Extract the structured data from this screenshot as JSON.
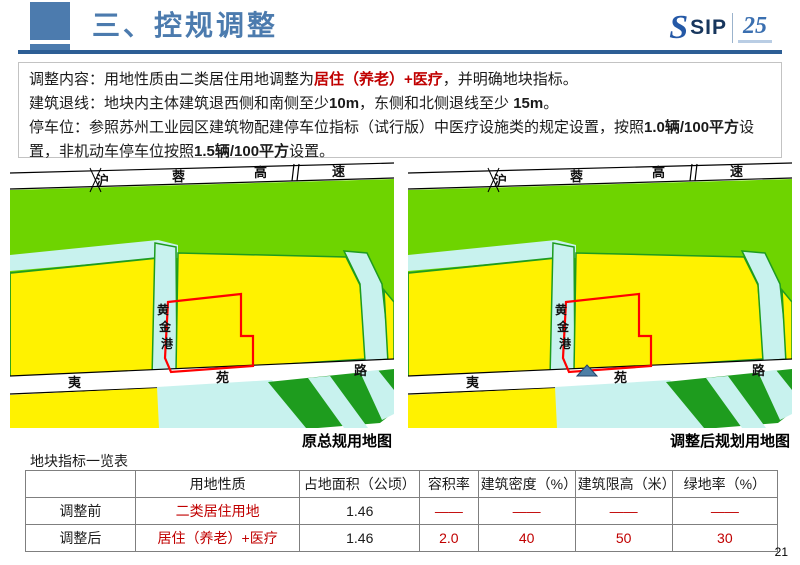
{
  "header": {
    "title": "三、控规调整",
    "logo": {
      "s": "S",
      "sip": "SIP",
      "anniversary": "25"
    }
  },
  "content": {
    "lines": [
      {
        "segments": [
          {
            "t": "调整内容：用地性质由二类居住用地调整为",
            "s": "normal"
          },
          {
            "t": "居住（养老）+医疗",
            "s": "red-bold"
          },
          {
            "t": "，并明确地块指标。",
            "s": "normal"
          }
        ]
      },
      {
        "segments": [
          {
            "t": "建筑退线：地块内主体建筑退西侧和南侧至少",
            "s": "normal"
          },
          {
            "t": "10m",
            "s": "bold"
          },
          {
            "t": "，东侧和北侧退线至少 ",
            "s": "normal"
          },
          {
            "t": "15m",
            "s": "bold"
          },
          {
            "t": "。",
            "s": "normal"
          }
        ]
      },
      {
        "segments": [
          {
            "t": "停车位：参照苏州工业园区建筑物配建停车位指标（试行版）中医疗设施类的规定设置，按照",
            "s": "normal"
          },
          {
            "t": "1.0辆/100平方",
            "s": "bold"
          },
          {
            "t": "设置，非机动车停车位按照",
            "s": "normal"
          },
          {
            "t": "1.5辆/100平方",
            "s": "bold"
          },
          {
            "t": "设置。",
            "s": "normal"
          }
        ]
      }
    ]
  },
  "maps": {
    "expressway_chars": [
      "沪",
      "蓉",
      "高",
      "速"
    ],
    "canal_chars": [
      "黄",
      "金",
      "港"
    ],
    "road_chars": [
      "夷",
      "苑",
      "路"
    ],
    "left_caption": "原总规用地图",
    "right_caption": "调整后规划用地图",
    "colors": {
      "green": "#6ED400",
      "yellow": "#FFF200",
      "cyan": "#C8F2EE",
      "dark_green": "#1E9C1E",
      "plot_red": "#FF0000",
      "marker_blue": "#4E7FA6"
    }
  },
  "table": {
    "title": "地块指标一览表",
    "headers": [
      "",
      "用地性质",
      "占地面积（公顷）",
      "容积率",
      "建筑密度（%）",
      "建筑限高（米）",
      "绿地率（%）"
    ],
    "rows": [
      {
        "label": "调整前",
        "cells": [
          "二类居住用地",
          "1.46",
          "——",
          "——",
          "——",
          "——"
        ]
      },
      {
        "label": "调整后",
        "cells": [
          "居住（养老）+医疗",
          "1.46",
          "2.0",
          "40",
          "50",
          "30"
        ]
      }
    ]
  },
  "page": {
    "number": "21"
  },
  "theme": {
    "title_blue": "#4C7BAE",
    "rule_blue": "#2D5E95",
    "accent_red": "#C00000"
  }
}
